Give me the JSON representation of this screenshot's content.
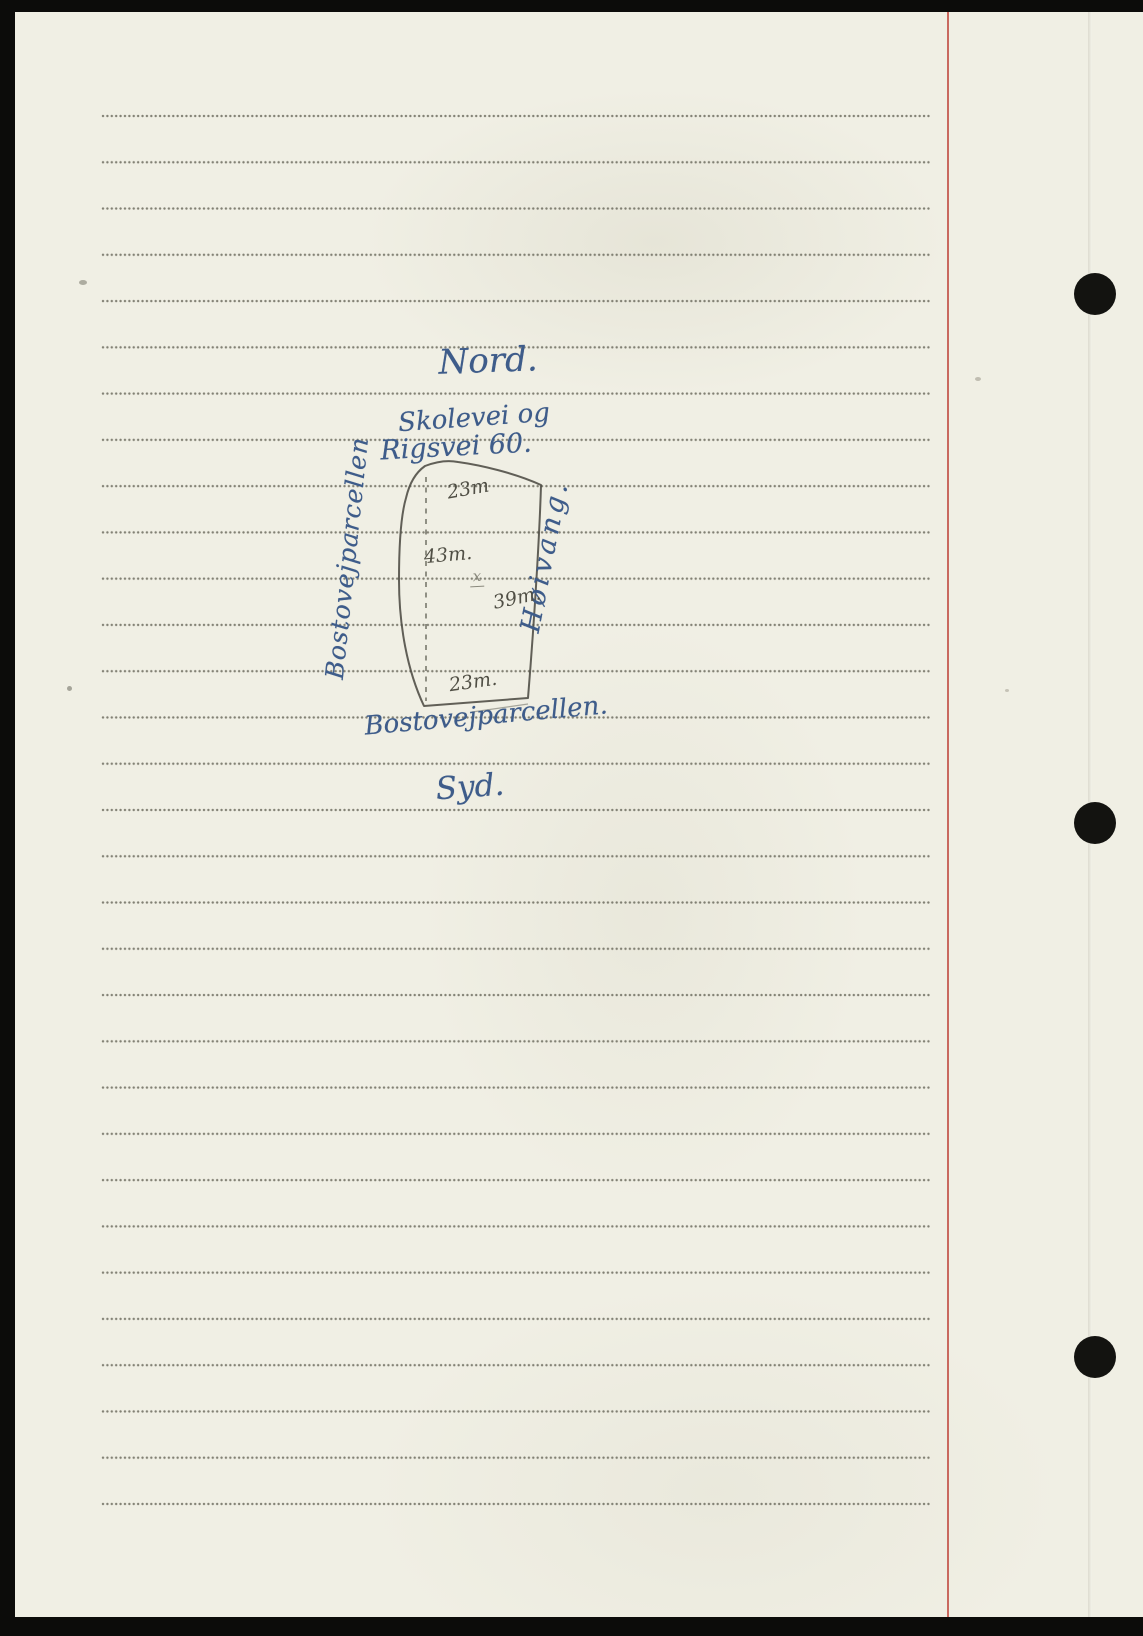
{
  "page": {
    "description": "Scanned lined notebook page with a hand-drawn land-parcel sketch in blue ink and pencil",
    "language": "Norwegian",
    "punch_hole_count": 3,
    "colors": {
      "paper": "#f0efe4",
      "ruled_dots": "#6e6d60",
      "margin_line_red": "#c25148",
      "ink_blue": "#3e5c8a",
      "pencil_gray": "#4c4b43",
      "scan_background": "#0c0c0a"
    }
  },
  "sketch": {
    "compass": {
      "north": "Nord.",
      "south": "Syd."
    },
    "roads": {
      "line1": "Skolevei og",
      "line2": "Rigsvei 60."
    },
    "measurements": {
      "top": "23m",
      "left": "43m.",
      "right": "39m.",
      "bottom": "23m."
    },
    "center_mark": "x",
    "neighbors": {
      "west": "Bostovejparcellen",
      "east": "Høivang."
    },
    "caption": "Bostovejparcellen."
  }
}
